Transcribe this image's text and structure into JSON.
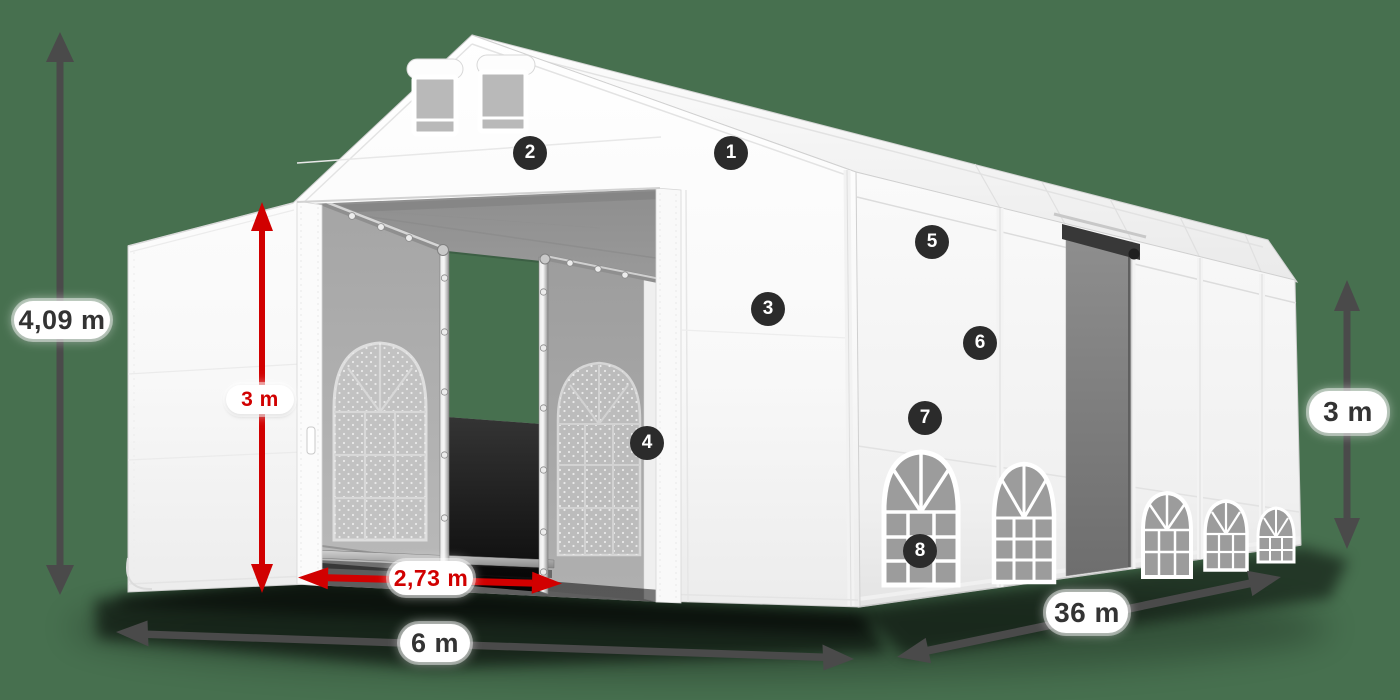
{
  "scene": {
    "type": "product-illustration",
    "subject": "white storage marquee tent with dimension annotations and numbered feature callouts",
    "background_color": "#47704F"
  },
  "colors": {
    "dimension_red": "#D10000",
    "dimension_dark": "#4A4A4A",
    "badge_background": "#2B2B2B",
    "badge_text": "#FFFFFF",
    "label_background": "#FFFFFF",
    "label_text_dark": "#333333",
    "tent_white": "#FFFFFF"
  },
  "dimensions": {
    "total_height": "4,09 m",
    "door_height": "3 m",
    "door_width": "2,73 m",
    "front_width": "6 m",
    "side_length": "36 m",
    "side_height": "3 m"
  },
  "badges": [
    {
      "number": "1"
    },
    {
      "number": "2"
    },
    {
      "number": "3"
    },
    {
      "number": "4"
    },
    {
      "number": "5"
    },
    {
      "number": "6"
    },
    {
      "number": "7"
    },
    {
      "number": "8"
    }
  ]
}
